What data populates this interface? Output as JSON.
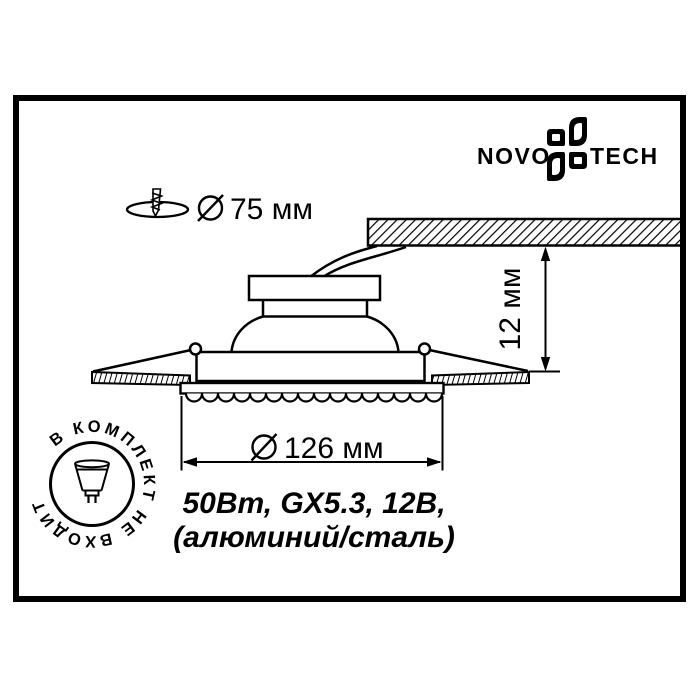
{
  "brand": {
    "left": "NOVO",
    "right": "TECH",
    "icon": "novotech-pinwheel"
  },
  "dimensions": {
    "diameter_symbol": "⌀",
    "cutout_diameter": "75 мм",
    "recess_depth": "12 мм",
    "trim_diameter": "126 мм"
  },
  "specs": {
    "line1": "50Вт, GX5.3, 12В,",
    "line2": "(алюминий/сталь)"
  },
  "badge": {
    "text": "В КОМПЛЕКТ НЕ ВХОДИТ",
    "icon": "mr16-lamp"
  },
  "colors": {
    "ink": "#000000",
    "paper": "#ffffff"
  }
}
